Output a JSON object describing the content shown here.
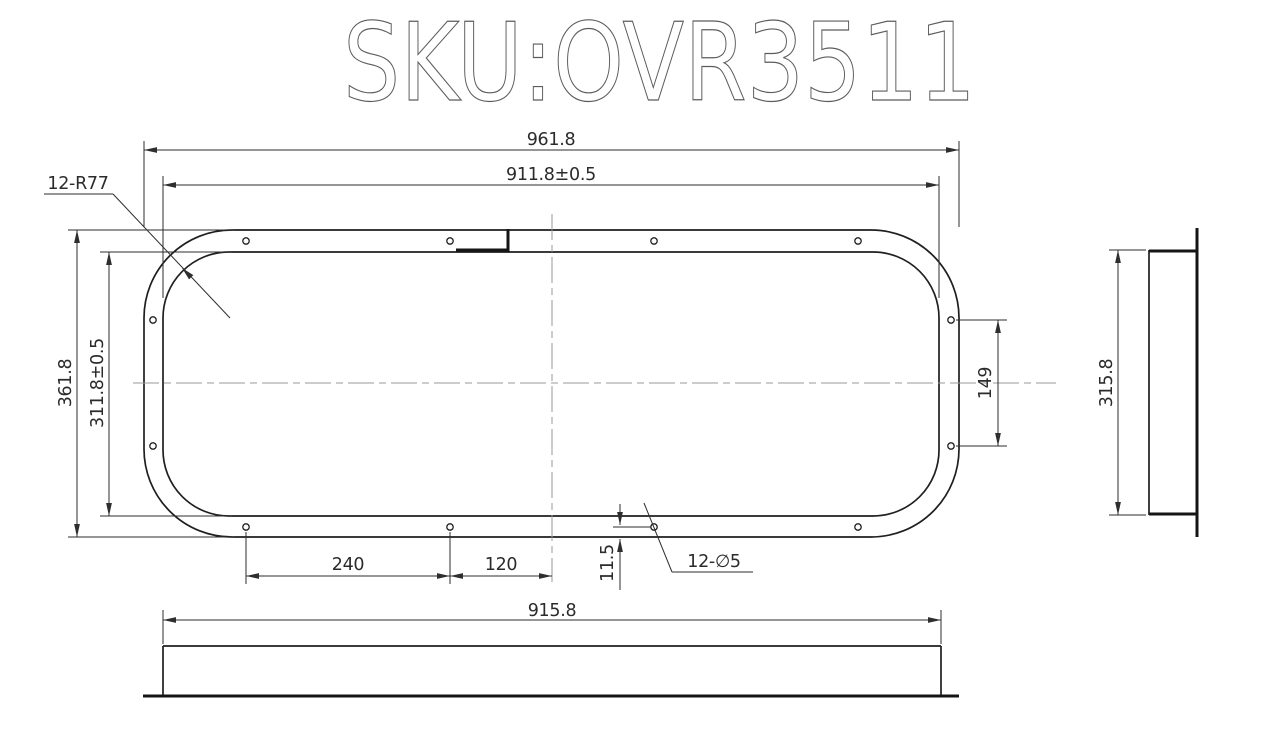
{
  "title": "SKU:OVR3511",
  "colors": {
    "line": "#1f1f1f",
    "centerline": "#9a9a9a",
    "background": "#ffffff"
  },
  "front_view": {
    "dim_outer_width": "961.8",
    "dim_inner_width": "911.8±0.5",
    "dim_outer_height": "361.8",
    "dim_inner_height": "311.8±0.5",
    "label_corner_radius": "12-R77",
    "dim_side_hole_spacing": "149",
    "dim_hole_pitch": "240",
    "dim_hole_to_center": "120",
    "dim_hole_edge_offset": "11.5",
    "label_holes": "12-∅5"
  },
  "bottom_view": {
    "dim_width": "915.8"
  },
  "side_view": {
    "dim_height": "315.8"
  }
}
